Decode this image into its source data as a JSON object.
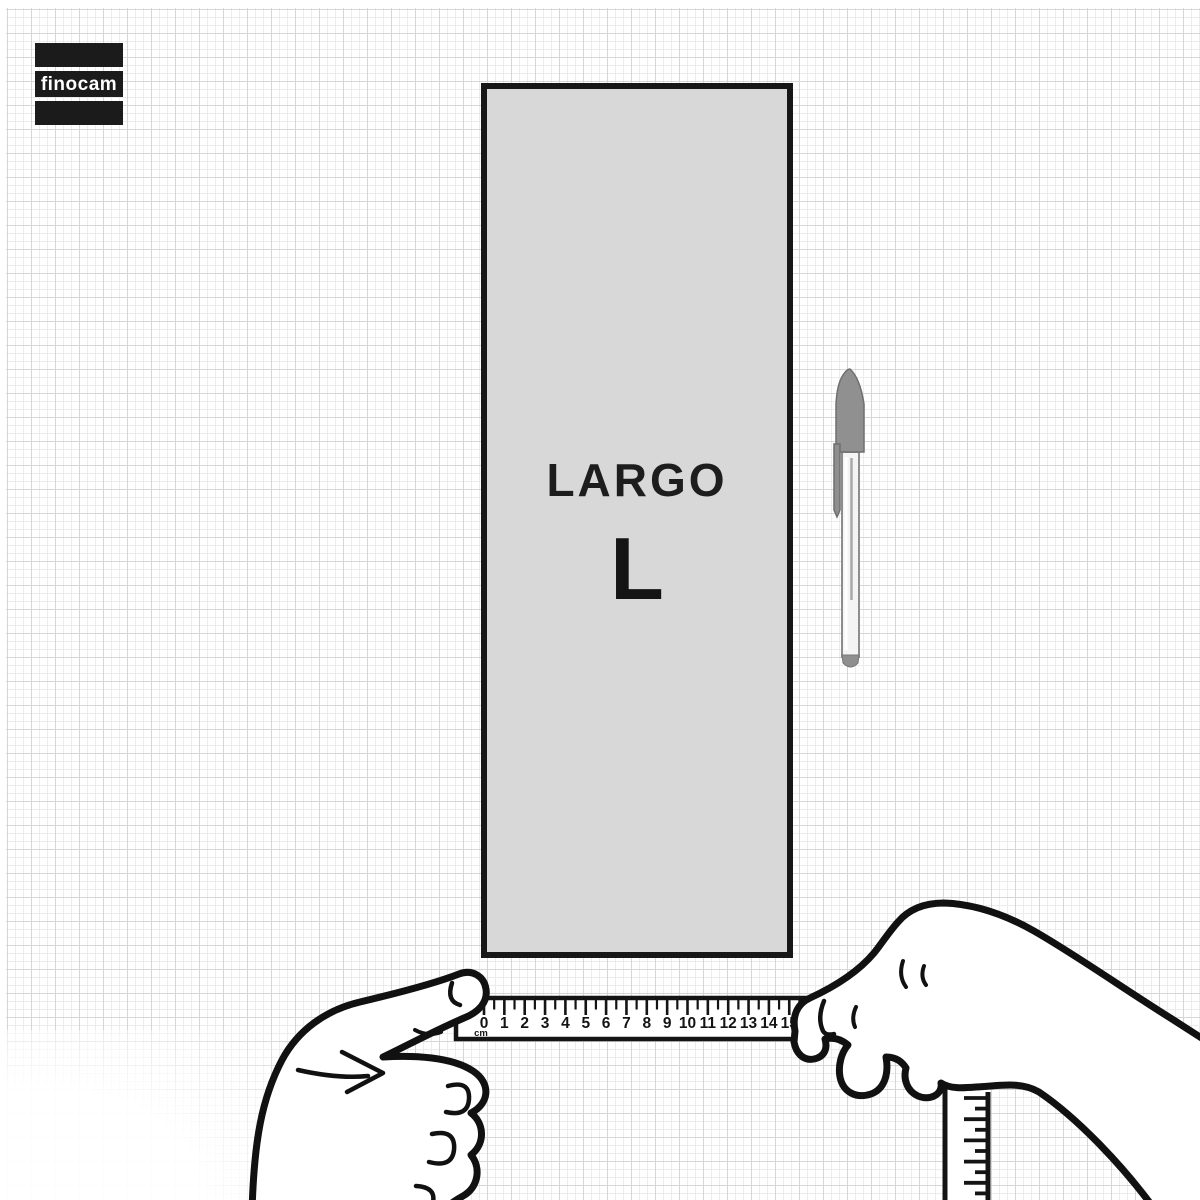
{
  "brand": {
    "logo_text": "finocam"
  },
  "diagram": {
    "dimension_label": "LARGO",
    "dimension_letter": "L"
  },
  "ruler": {
    "unit": "cm",
    "numbers": [
      "0",
      "1",
      "2",
      "3",
      "4",
      "5",
      "6",
      "7",
      "8",
      "9",
      "10",
      "11",
      "12",
      "13",
      "14",
      "15"
    ]
  },
  "icons": {
    "pen": "ballpoint-pen-icon",
    "left_hand": "left-hand-holding-tape",
    "right_hand": "right-hand-holding-tape",
    "vertical_tape": "tape-measure-tail"
  },
  "colors": {
    "rectangle_fill": "#d8d8d8",
    "outline_ink": "#141414",
    "logo_background": "#1b1b1b",
    "logo_text": "#ffffff",
    "pen_gray": "#8f8f8f",
    "grid_fine": "#ececec",
    "grid_accent": "#d6d6d6"
  }
}
